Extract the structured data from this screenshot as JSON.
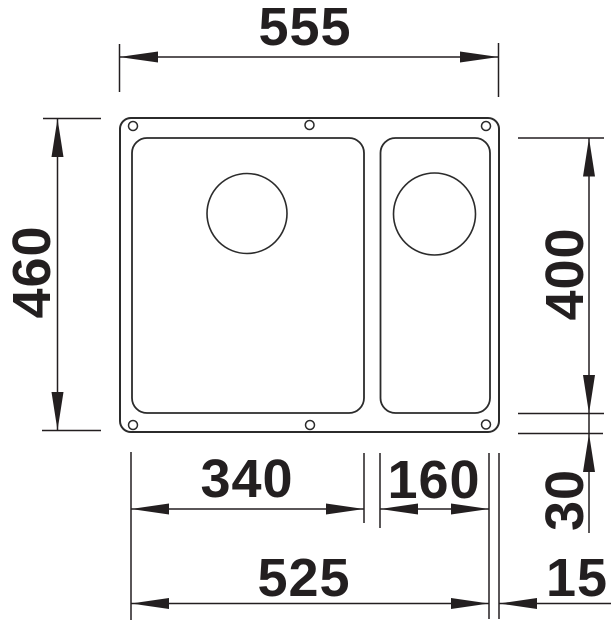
{
  "drawing": {
    "subject": "undermount sink with main bowl and half bowl, top view dimension drawing",
    "line_color": "#231f20",
    "background_color": "#ffffff",
    "dimensions": {
      "overall_width": "555",
      "overall_depth": "460",
      "bowl_depth": "400",
      "main_bowl_width": "340",
      "small_bowl_width": "160",
      "bowl_span_width": "525",
      "right_edge_offset": "15",
      "bottom_edge_offset": "30"
    }
  }
}
